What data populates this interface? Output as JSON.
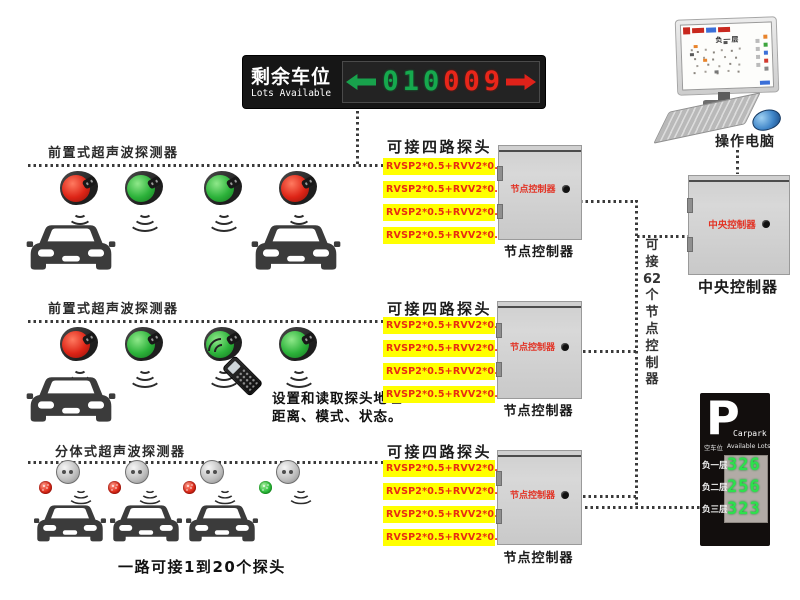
{
  "colors": {
    "highlight_yellow": "#ffff00",
    "status_red": "#dd2416",
    "status_green": "#2cb23a",
    "cabinet_label_red": "#e23325",
    "led_green": "#16a94e",
    "led_red": "#e8261a",
    "sign_digit_green": "#2ce24c"
  },
  "led_board": {
    "title_cn": "剩余车位",
    "title_en": "Lots Available",
    "left_arrow_color": "#18a24c",
    "right_arrow_color": "#e0221a",
    "digits": [
      {
        "value": "0",
        "color": "green"
      },
      {
        "value": "1",
        "color": "green"
      },
      {
        "value": "0",
        "color": "green"
      },
      {
        "value": "0",
        "color": "red"
      },
      {
        "value": "0",
        "color": "red"
      },
      {
        "value": "9",
        "color": "red"
      }
    ]
  },
  "computer": {
    "label": "操作电脑",
    "screen_title": "负一层"
  },
  "rows": [
    {
      "label": "前置式超声波探测器",
      "detectors": [
        "red",
        "green",
        "green",
        "red"
      ]
    },
    {
      "label": "前置式超声波探测器",
      "detectors": [
        "red",
        "green",
        "green",
        "green"
      ]
    },
    {
      "label": "分体式超声波探测器",
      "lamps": [
        "red",
        "red",
        "red",
        "green"
      ]
    }
  ],
  "probe_sections": [
    {
      "title": "可接四路探头",
      "lines": [
        "RVSP2*0.5+RVV2*0.5:1",
        "RVSP2*0.5+RVV2*0.5:2",
        "RVSP2*0.5+RVV2*0.5:3",
        "RVSP2*0.5+RVV2*0.5:4"
      ]
    },
    {
      "title": "可接四路探头",
      "lines": [
        "RVSP2*0.5+RVV2*0.5:1",
        "RVSP2*0.5+RVV2*0.5:2",
        "RVSP2*0.5+RVV2*0.5:3",
        "RVSP2*0.5+RVV2*0.5:4"
      ]
    },
    {
      "title": "可接四路探头",
      "lines": [
        "RVSP2*0.5+RVV2*0.5:1",
        "RVSP2*0.5+RVV2*0.5:2",
        "RVSP2*0.5+RVV2*0.5:3",
        "RVSP2*0.5+RVV2*0.5:4"
      ]
    }
  ],
  "node_controller": {
    "box_label": "节点控制器",
    "caption": "节点控制器"
  },
  "central_controller": {
    "box_label": "中央控制器",
    "caption": "中央控制器"
  },
  "trunk_note_chars": [
    "可",
    "接",
    "62",
    "个",
    "节",
    "点",
    "控",
    "制",
    "器"
  ],
  "remote_note": {
    "line1": "设置和读取探头地址",
    "line2": "距离、模式、状态。"
  },
  "bottom_note": "一路可接1到20个探头",
  "parking_sign": {
    "p": "P",
    "brand": "Carpark",
    "subtitle_cn": "空车位",
    "subtitle_en": "Available Lots",
    "floors": [
      {
        "label": "负一层",
        "value": "326"
      },
      {
        "label": "负二层",
        "value": "256"
      },
      {
        "label": "负三层",
        "value": "323"
      }
    ]
  }
}
